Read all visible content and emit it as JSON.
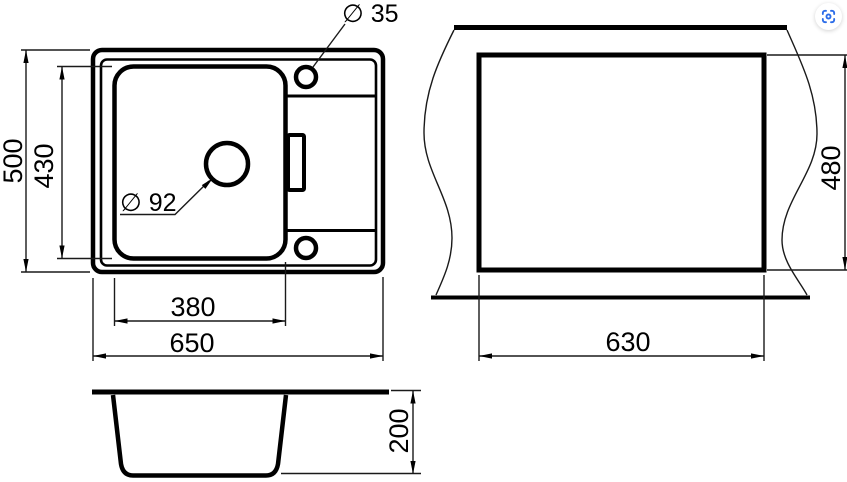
{
  "app": {
    "background": "#ffffff",
    "line_color": "#000000",
    "accent_blue": "#2b6ce8"
  },
  "views": {
    "top": {
      "dims": {
        "overall_width": "650",
        "overall_depth": "500",
        "bowl_width": "380",
        "bowl_depth": "430",
        "tap_hole_diameter": "∅ 35",
        "drain_diameter": "∅ 92"
      }
    },
    "cutout": {
      "dims": {
        "width": "630",
        "height": "480"
      }
    },
    "side": {
      "dims": {
        "depth": "200"
      }
    }
  },
  "controls": {
    "visual_search_icon": "camera-scan"
  }
}
